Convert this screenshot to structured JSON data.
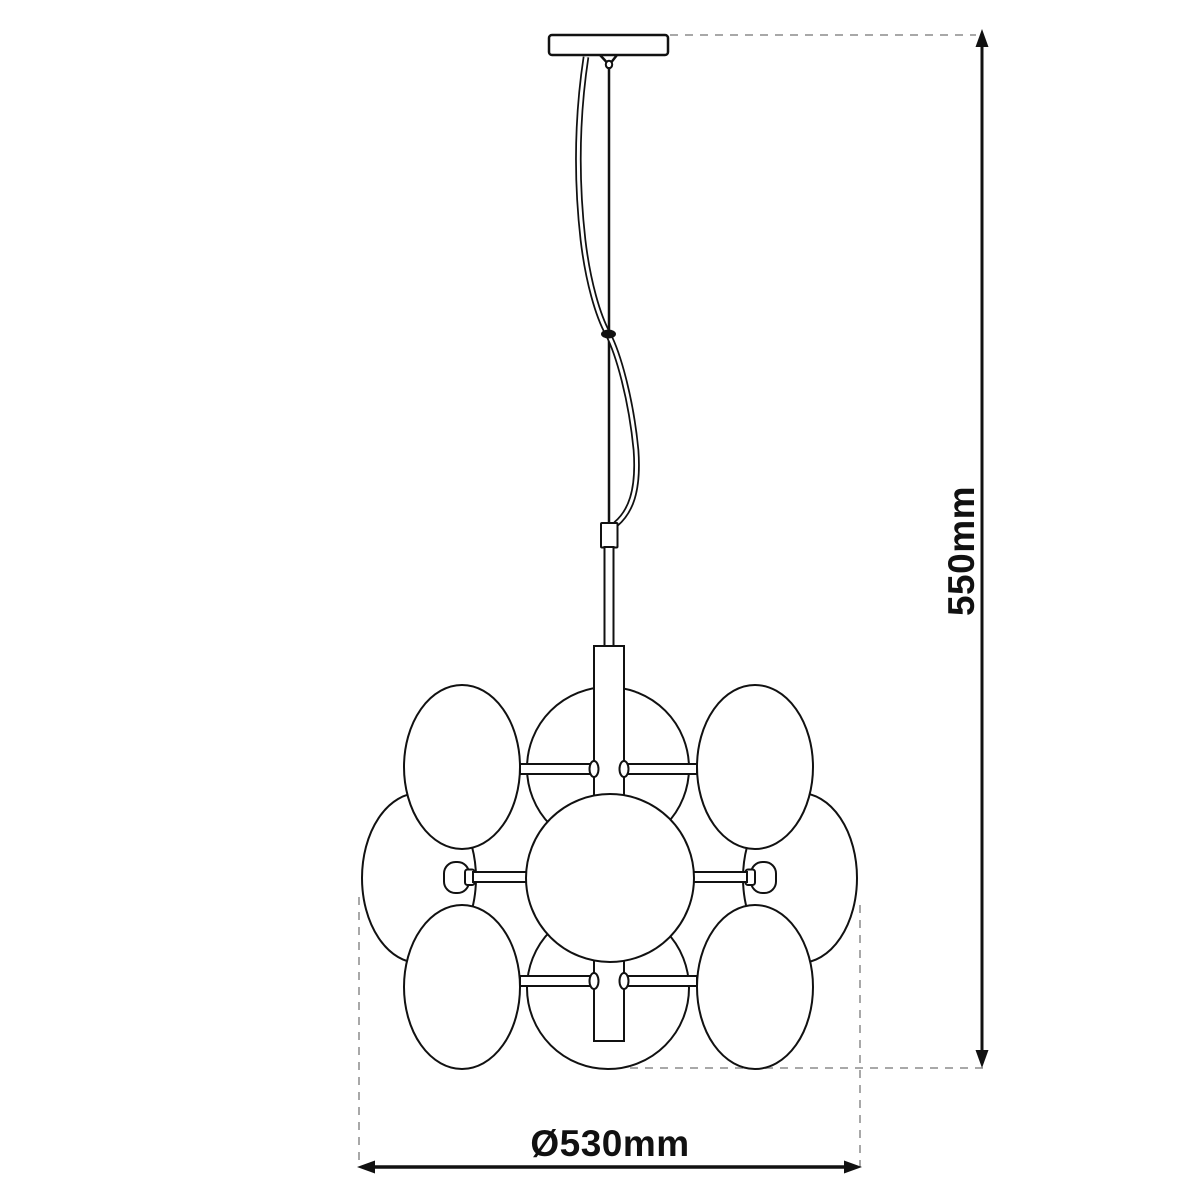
{
  "diagram": {
    "labels": {
      "height": "550mm",
      "diameter": "Ø530mm"
    },
    "colors": {
      "line": "#111111",
      "dashed_line": "#a8a8a8",
      "text": "#111111",
      "background": "#ffffff"
    }
  }
}
